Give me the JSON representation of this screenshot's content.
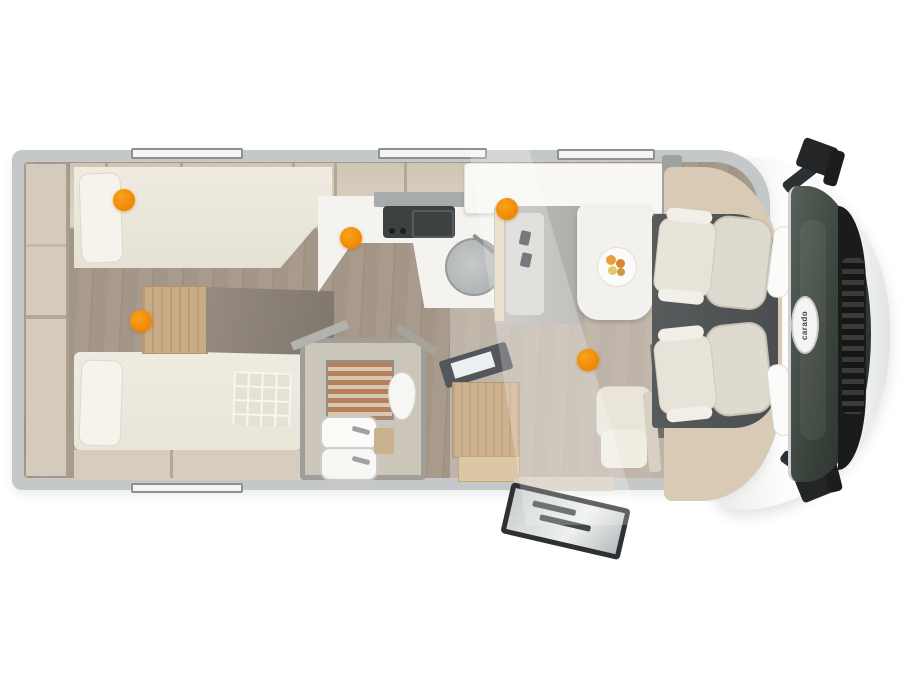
{
  "page": {
    "background_color": "#ffffff"
  },
  "vehicle": {
    "type": "motorhome-floorplan-top-view",
    "brand_logo": "carado",
    "hotspot_color": "#EE8500",
    "hotspots": [
      {
        "id": "hotspot-rear-bed-top",
        "x": 124,
        "y": 200
      },
      {
        "id": "hotspot-rear-steps",
        "x": 141,
        "y": 321
      },
      {
        "id": "hotspot-kitchen",
        "x": 351,
        "y": 238
      },
      {
        "id": "hotspot-dinette",
        "x": 507,
        "y": 209
      },
      {
        "id": "hotspot-lounge-floor",
        "x": 588,
        "y": 360
      }
    ]
  }
}
